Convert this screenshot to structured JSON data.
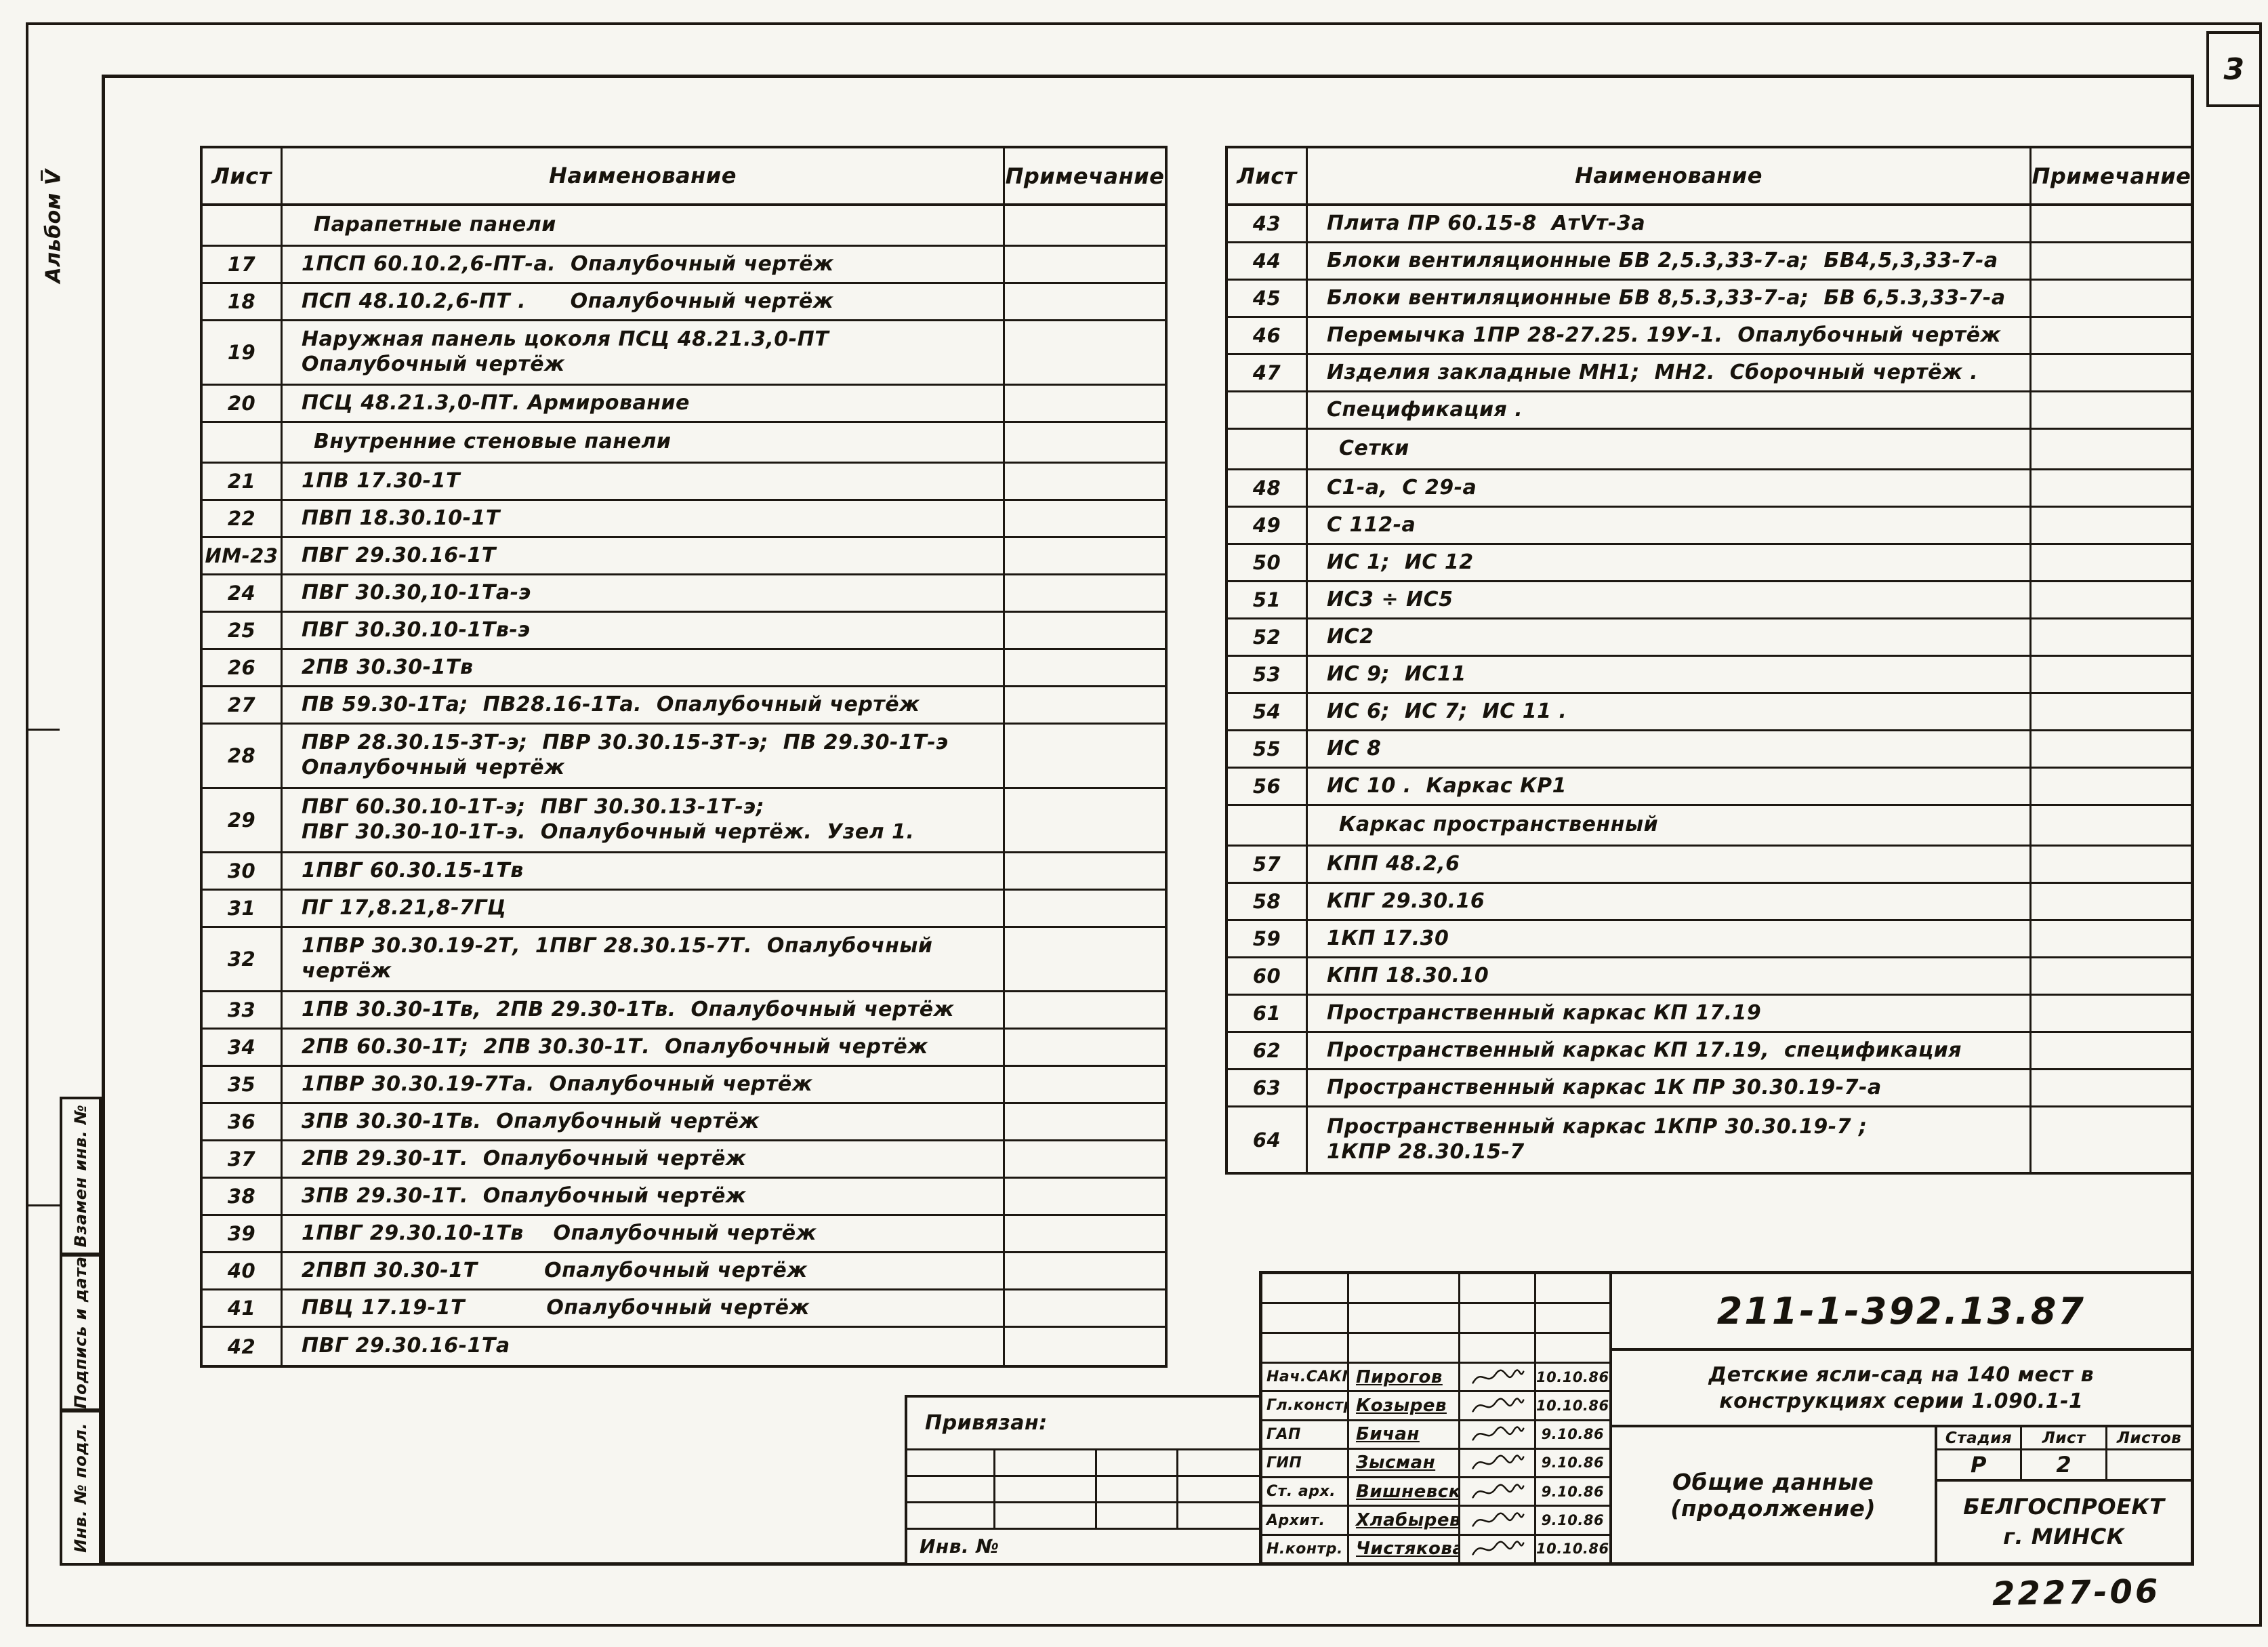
{
  "page": {
    "page_number": "3",
    "album_label": "Альбом V̅",
    "stamp_number": "2227-06"
  },
  "side_stamps": [
    "Взамен инв. №",
    "Подпись и дата",
    "Инв. № подл."
  ],
  "left_table": {
    "headers": {
      "sheet": "Лист",
      "name": "Наименование",
      "note": "Примечание"
    },
    "rows": [
      {
        "sheet": "",
        "name": "Парапетные панели",
        "type": "section"
      },
      {
        "sheet": "17",
        "name": "1ПСП 60.10.2,6-ПТ-а.  Опалубочный чертёж"
      },
      {
        "sheet": "18",
        "name": "ПСП 48.10.2,6-ПТ .      Опалубочный чертёж"
      },
      {
        "sheet": "19",
        "name": "Наружная панель цоколя ПСЦ 48.21.3,0-ПТ\nОпалубочный чертёж",
        "lines": 2
      },
      {
        "sheet": "20",
        "name": "ПСЦ 48.21.3,0-ПТ. Армирование"
      },
      {
        "sheet": "",
        "name": "Внутренние стеновые панели",
        "type": "section"
      },
      {
        "sheet": "21",
        "name": "1ПВ 17.30-1Т"
      },
      {
        "sheet": "22",
        "name": "ПВП 18.30.10-1Т"
      },
      {
        "sheet": "ИМ-23",
        "name": "ПВГ 29.30.16-1Т"
      },
      {
        "sheet": "24",
        "name": "ПВГ 30.30,10-1Та-э"
      },
      {
        "sheet": "25",
        "name": "ПВГ 30.30.10-1Тв-э"
      },
      {
        "sheet": "26",
        "name": "2ПВ 30.30-1Тв"
      },
      {
        "sheet": "27",
        "name": "ПВ 59.30-1Та;  ПВ28.16-1Та.  Опалубочный чертёж"
      },
      {
        "sheet": "28",
        "name": "ПВР 28.30.15-3Т-э;  ПВР 30.30.15-3Т-э;  ПВ 29.30-1Т-э\nОпалубочный чертёж",
        "lines": 2
      },
      {
        "sheet": "29",
        "name": "ПВГ 60.30.10-1Т-э;  ПВГ 30.30.13-1Т-э;\nПВГ 30.30-10-1Т-э.  Опалубочный чертёж.  Узел 1.",
        "lines": 2
      },
      {
        "sheet": "30",
        "name": "1ПВГ 60.30.15-1Тв"
      },
      {
        "sheet": "31",
        "name": "ПГ 17,8.21,8-7ГЦ"
      },
      {
        "sheet": "32",
        "name": "1ПВР 30.30.19-2Т,  1ПВГ 28.30.15-7Т.  Опалубочный\nчертёж",
        "lines": 2
      },
      {
        "sheet": "33",
        "name": "1ПВ 30.30-1Тв,  2ПВ 29.30-1Тв.  Опалубочный чертёж"
      },
      {
        "sheet": "34",
        "name": "2ПВ 60.30-1Т;  2ПВ 30.30-1Т.  Опалубочный чертёж"
      },
      {
        "sheet": "35",
        "name": "1ПВР 30.30.19-7Та.  Опалубочный чертёж"
      },
      {
        "sheet": "36",
        "name": "3ПВ 30.30-1Тв.  Опалубочный чертёж"
      },
      {
        "sheet": "37",
        "name": "2ПВ 29.30-1Т.  Опалубочный чертёж"
      },
      {
        "sheet": "38",
        "name": "3ПВ 29.30-1Т.  Опалубочный чертёж"
      },
      {
        "sheet": "39",
        "name": "1ПВГ 29.30.10-1Тв    Опалубочный чертёж"
      },
      {
        "sheet": "40",
        "name": "2ПВП 30.30-1Т         Опалубочный чертёж"
      },
      {
        "sheet": "41",
        "name": "ПВЦ 17.19-1Т           Опалубочный чертёж"
      },
      {
        "sheet": "42",
        "name": "ПВГ 29.30.16-1Та"
      }
    ]
  },
  "right_table": {
    "headers": {
      "sheet": "Лист",
      "name": "Наименование",
      "note": "Примечание"
    },
    "rows": [
      {
        "sheet": "43",
        "name": "Плита ПР 60.15-8  АтVт-3а"
      },
      {
        "sheet": "44",
        "name": "Блоки вентиляционные БВ 2,5.3,33-7-а;  БВ4,5,3,33-7-а"
      },
      {
        "sheet": "45",
        "name": "Блоки вентиляционные БВ 8,5.3,33-7-а;  БВ 6,5.3,33-7-а"
      },
      {
        "sheet": "46",
        "name": "Перемычка 1ПР 28-27.25. 19У-1.  Опалубочный чертёж"
      },
      {
        "sheet": "47",
        "name": "Изделия закладные МН1;  МН2.  Сборочный чертёж ."
      },
      {
        "sheet": "",
        "name": "Спецификация ."
      },
      {
        "sheet": "",
        "name": "Сетки",
        "type": "section"
      },
      {
        "sheet": "48",
        "name": "С1-а,  С 29-а"
      },
      {
        "sheet": "49",
        "name": "С 112-а"
      },
      {
        "sheet": "50",
        "name": "ИС 1;  ИС 12"
      },
      {
        "sheet": "51",
        "name": "ИС3 ÷ ИС5"
      },
      {
        "sheet": "52",
        "name": "ИС2"
      },
      {
        "sheet": "53",
        "name": "ИС 9;  ИС11"
      },
      {
        "sheet": "54",
        "name": "ИС 6;  ИС 7;  ИС 11 ."
      },
      {
        "sheet": "55",
        "name": "ИС 8"
      },
      {
        "sheet": "56",
        "name": "ИС 10 .  Каркас КР1"
      },
      {
        "sheet": "",
        "name": "Каркас пространственный",
        "type": "section"
      },
      {
        "sheet": "57",
        "name": "КПП 48.2,6"
      },
      {
        "sheet": "58",
        "name": "КПГ 29.30.16"
      },
      {
        "sheet": "59",
        "name": "1КП 17.30"
      },
      {
        "sheet": "60",
        "name": "КПП 18.30.10"
      },
      {
        "sheet": "61",
        "name": "Пространственный каркас КП 17.19"
      },
      {
        "sheet": "62",
        "name": "Пространственный каркас КП 17.19,  спецификация"
      },
      {
        "sheet": "63",
        "name": "Пространственный каркас 1К ПР 30.30.19-7-а"
      },
      {
        "sheet": "64",
        "name": "Пространственный каркас 1КПР 30.30.19-7 ;\n1КПР 28.30.15-7",
        "lines": 2
      }
    ]
  },
  "title_block": {
    "doc_number": "211-1-392.13.87",
    "project_title_line1": "Детские ясли-сад на 140 мест в",
    "project_title_line2": "конструкциях серии 1.090.1-1",
    "sheet_title": "Общие данные (продолжение)",
    "organization_line1": "БЕЛГОСПРОЕКТ",
    "organization_line2": "г. МИНСК",
    "stage_label": "Стадия",
    "sheet_label": "Лист",
    "sheets_label": "Листов",
    "stage_value": "Р",
    "sheet_value": "2",
    "sheets_value": "",
    "binding_label": "Привязан:",
    "inventory_label": "Инв. №",
    "signatures": [
      {
        "role": "Нач.САКМ",
        "name": "Пирогов",
        "date": "10.10.86"
      },
      {
        "role": "Гл.констр.",
        "name": "Козырев",
        "date": "10.10.86"
      },
      {
        "role": "ГАП",
        "name": "Бичан",
        "date": "9.10.86"
      },
      {
        "role": "ГИП",
        "name": "Зысман",
        "date": "9.10.86"
      },
      {
        "role": "Ст. арх.",
        "name": "Вишневская",
        "date": "9.10.86"
      },
      {
        "role": "Архит.",
        "name": "Хлабырева",
        "date": "9.10.86"
      },
      {
        "role": "Н.контр.",
        "name": "Чистякова",
        "date": "10.10.86"
      }
    ]
  }
}
